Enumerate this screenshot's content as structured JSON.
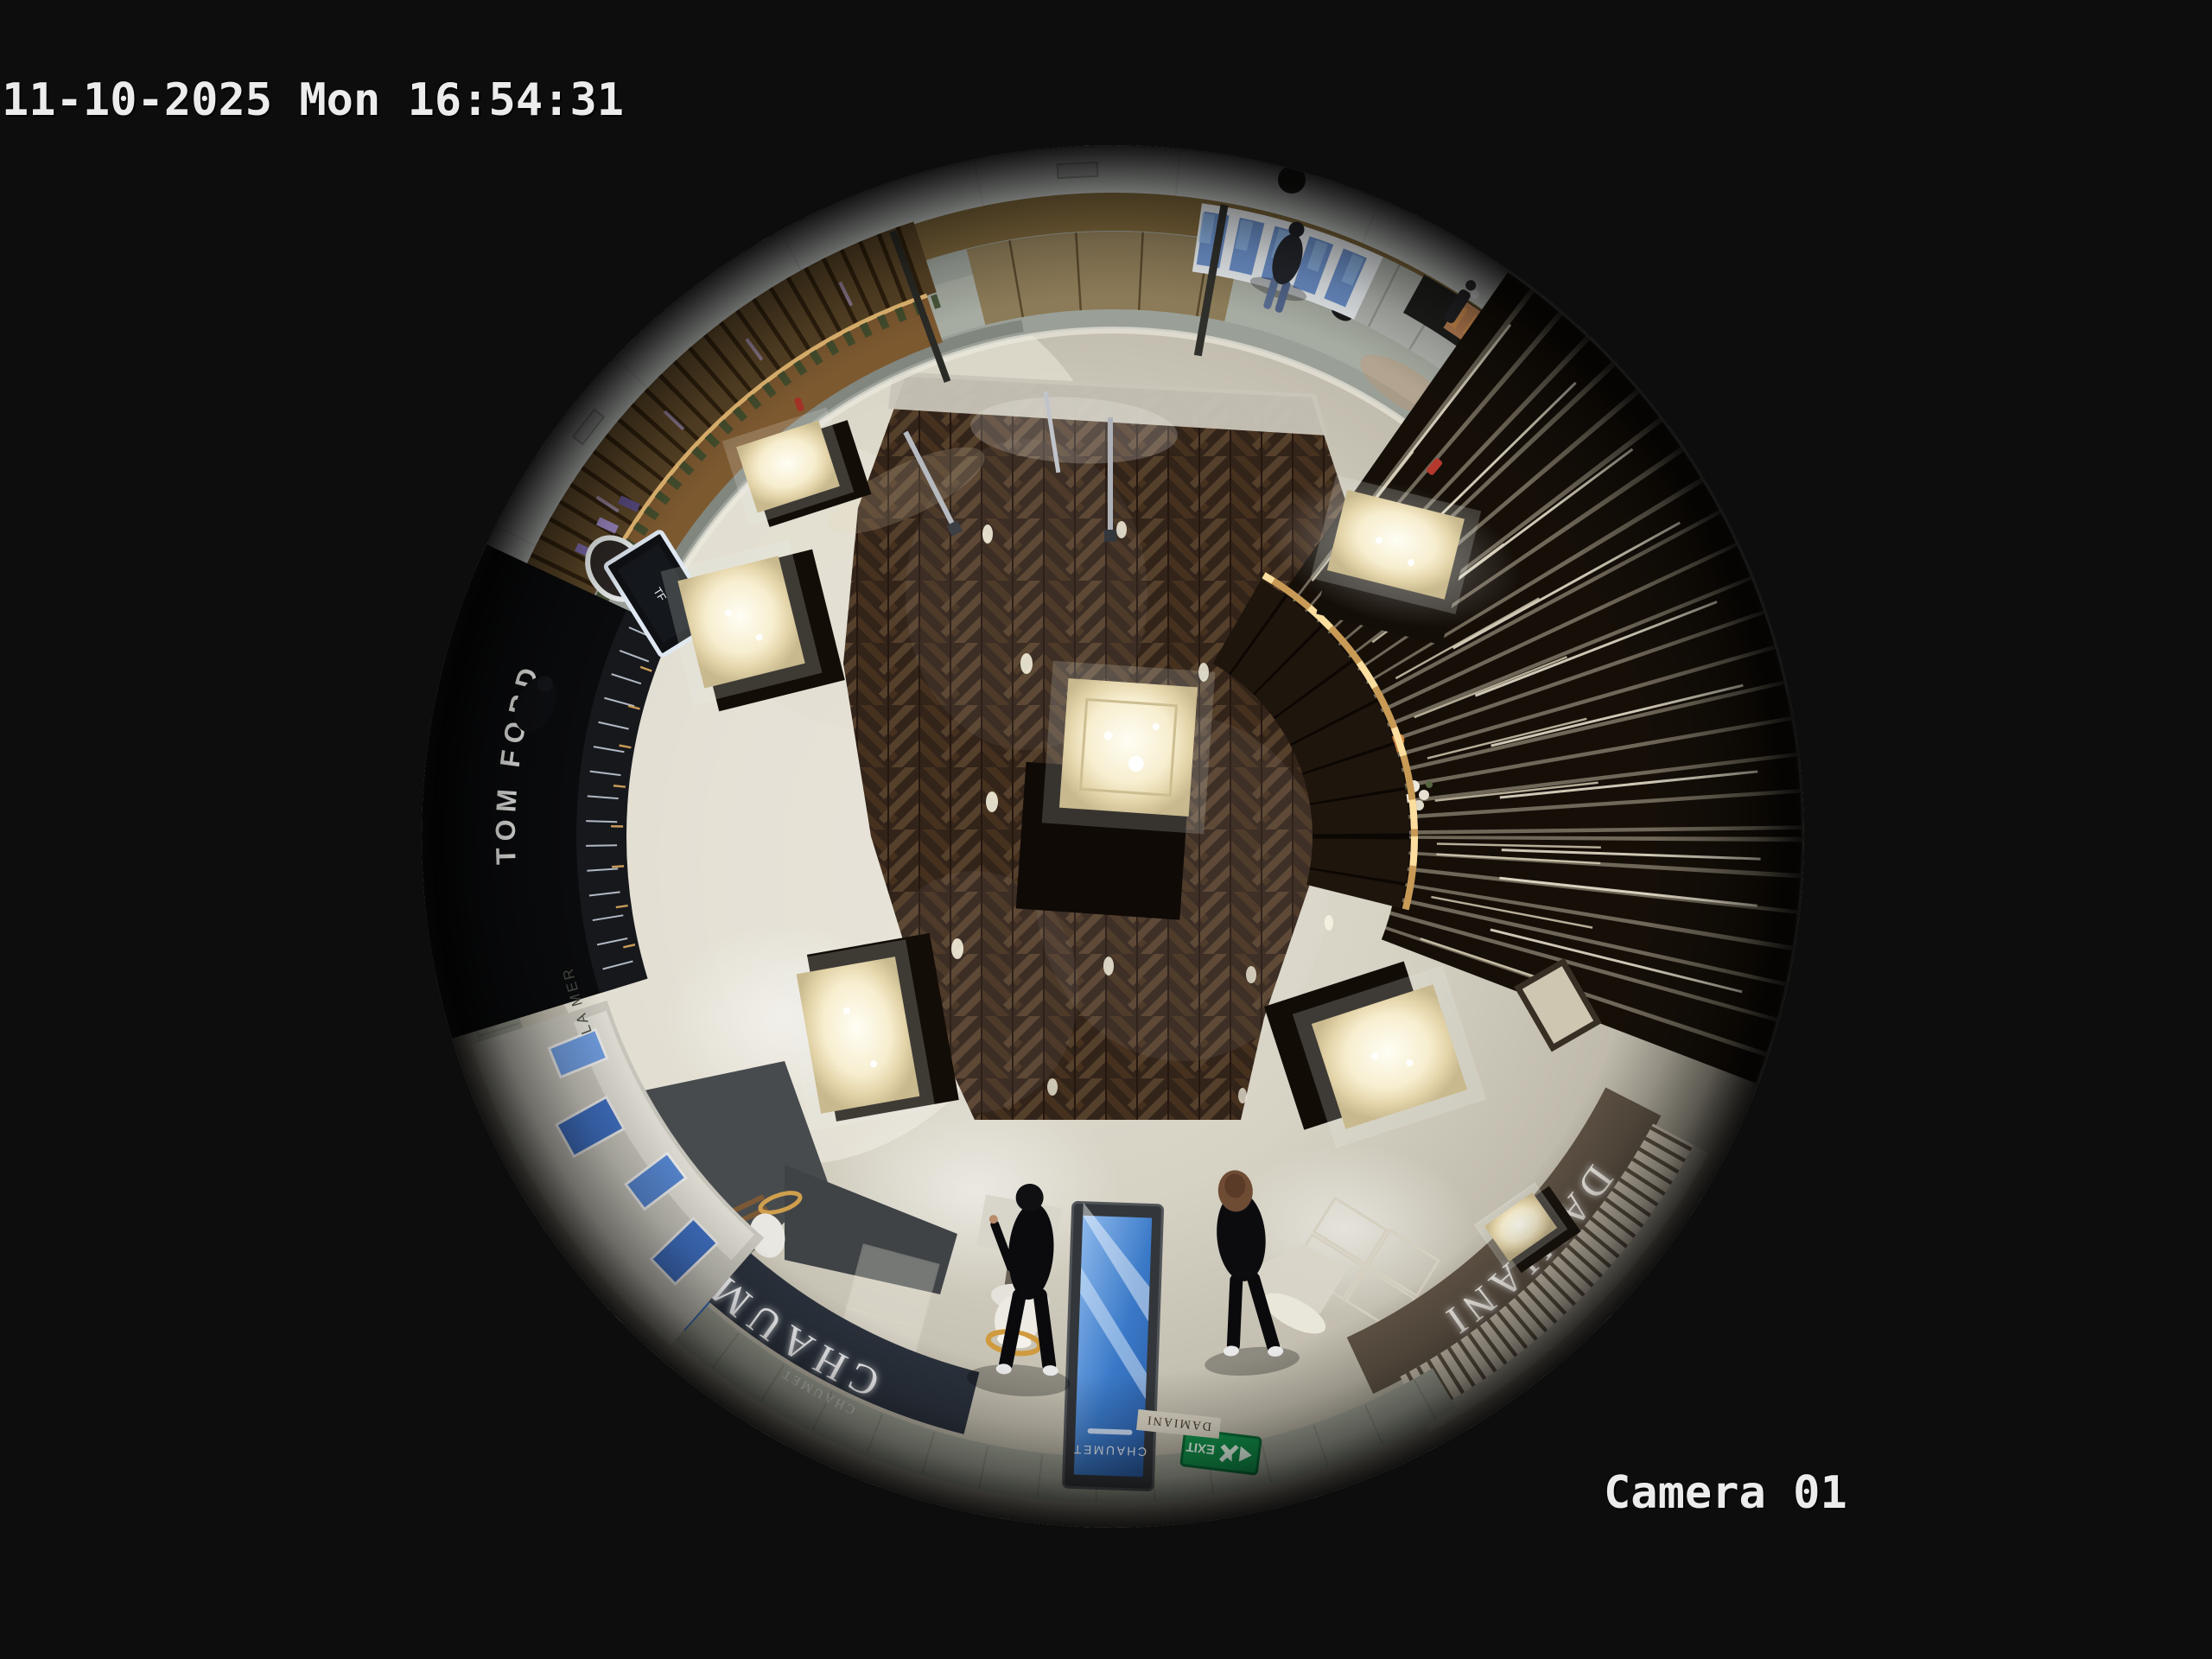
{
  "overlay": {
    "timestamp": "11-10-2025 Mon 16:54:31",
    "camera_label": "Camera 01"
  },
  "scene": {
    "stores": {
      "chaumet_sign": "CHAUMET",
      "chaumet_kiosk": "CHAUMET",
      "chaumet_glass": "CHAUMET",
      "damiani_sign": "DAMIANI",
      "damiani_small": "DAMIANI",
      "tom_ford_sign": "TOM FORD",
      "tf_logo": "TF",
      "la_mer_sign": "LA MER",
      "exit_sign": "EXIT"
    },
    "colors": {
      "background": "#0d0d0d",
      "osd_text": "#ececec",
      "exit_green": "#12934c",
      "kiosk_blue": "#3a79c8",
      "wood_floor": "#33241a",
      "gold_accent": "#c89a55",
      "fascia_chaumet": "#2b323d",
      "fascia_damiani": "#5e5244"
    }
  }
}
